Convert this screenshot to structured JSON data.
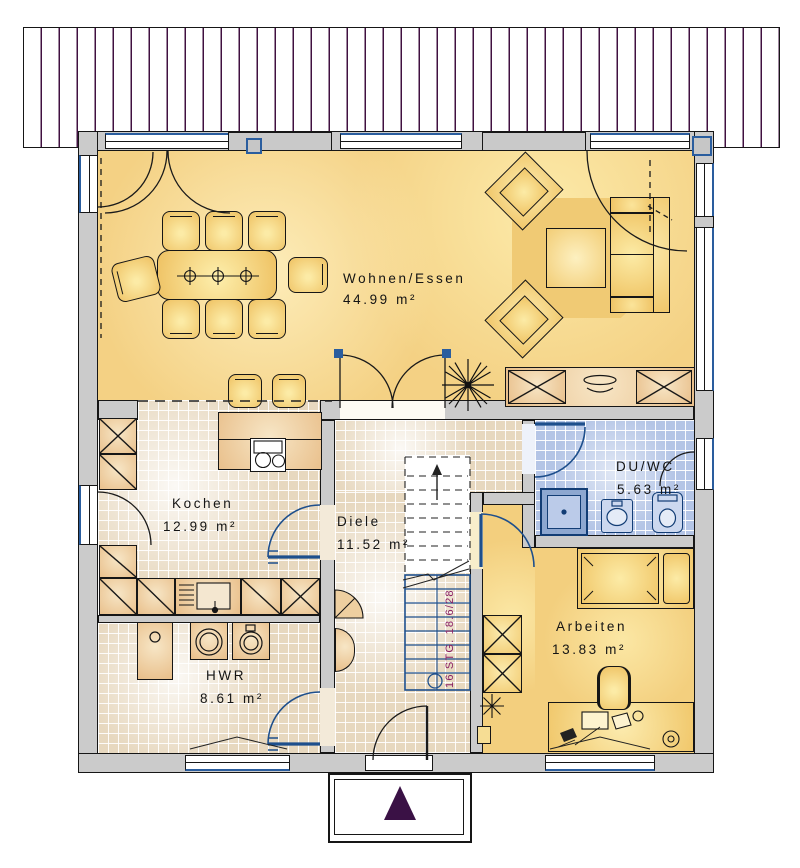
{
  "rooms": {
    "wohnen": {
      "label": "Wohnen/Essen",
      "area": "44.99 m²"
    },
    "kochen": {
      "label": "Kochen",
      "area": "12.99 m²"
    },
    "diele": {
      "label": "Diele",
      "area": "11.52 m²"
    },
    "duwc": {
      "label": "DU/WC",
      "area": "5.63 m²"
    },
    "arbeiten": {
      "label": "Arbeiten",
      "area": "13.83 m²"
    },
    "hwr": {
      "label": "HWR",
      "area": "8.61 m²"
    }
  },
  "stairs": {
    "label": "16 STG. 18.6/28"
  },
  "colors": {
    "wall_gray": "#cbcbcb",
    "floor_yellow": "#f4d184",
    "tile_beige": "#e7d8bf",
    "tile_blue": "#b4c5e6",
    "stripe_purple": "#401040",
    "fixture_blue": "#1e4f8c",
    "stair_text": "#8a1f63",
    "entrance_arrow": "#3a1145"
  }
}
